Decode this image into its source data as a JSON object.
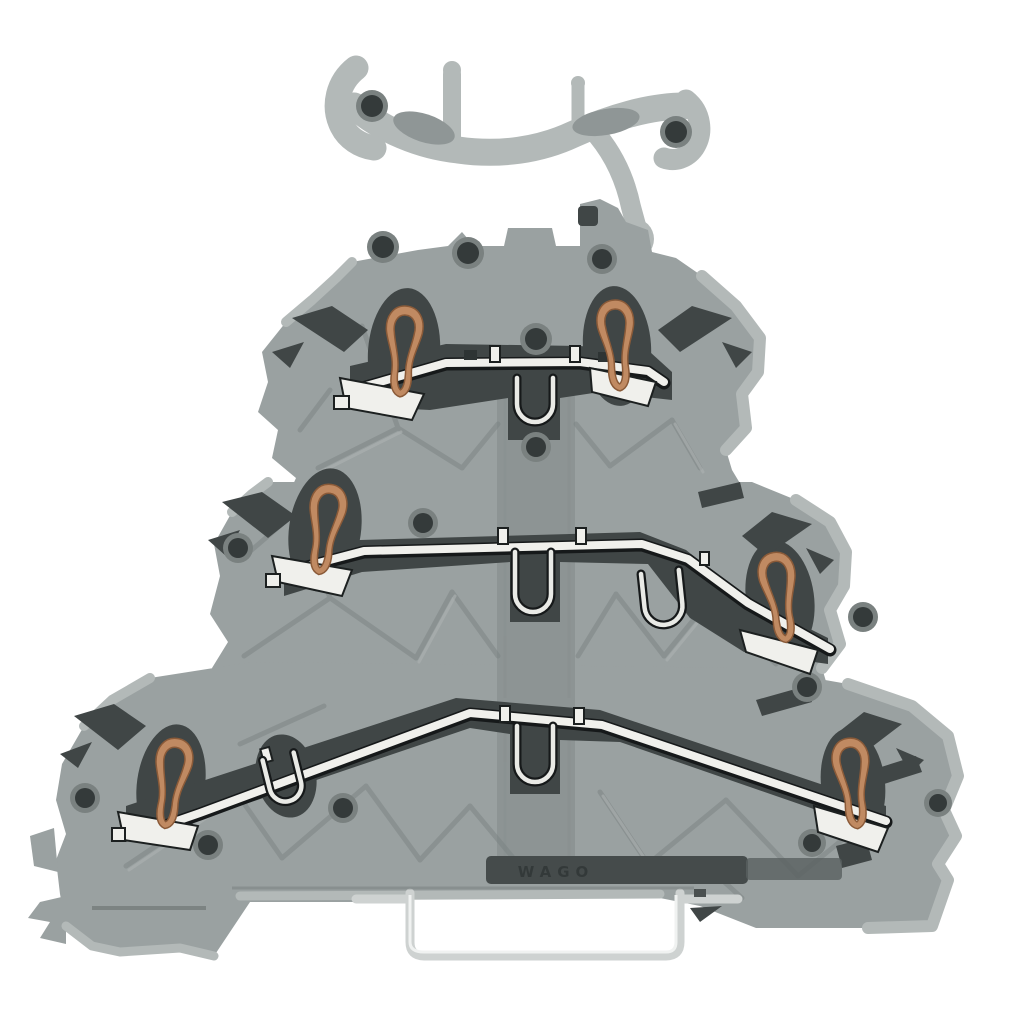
{
  "meta": {
    "kind": "product-photo",
    "subject": "Triple-deck rail-mount terminal block shown as cutaway render",
    "background": "#ffffff",
    "canvas": {
      "width": 1024,
      "height": 1024
    }
  },
  "product": {
    "embossed_label": "WAGO",
    "visible_parts": {
      "levels": 3,
      "copper_push_in_springs": 6,
      "tinned_busbars": 3,
      "steel_clamping_yokes": 5,
      "marker_jumper_carrier": 1,
      "din_rail_cross_section": 1,
      "rail_release_latch": 1
    }
  },
  "colors": {
    "background": "#ffffff",
    "body": "#9aa1a1",
    "body_light": "#b3b9b8",
    "cut_panel": "#8d9494",
    "recess": "#404646",
    "recess_deep": "#2e3434",
    "copper": "#c08a62",
    "copper_dark": "#8a5a38",
    "busbar": "#f0f0ec",
    "metal_outline": "#16191a",
    "steel_clip": "#e9eae6",
    "hole": "#343a3a",
    "hole_ring": "#7a8180",
    "rail_outline": "#ced2d1",
    "label_slot": "#454b4b",
    "label_text": "#313737"
  }
}
